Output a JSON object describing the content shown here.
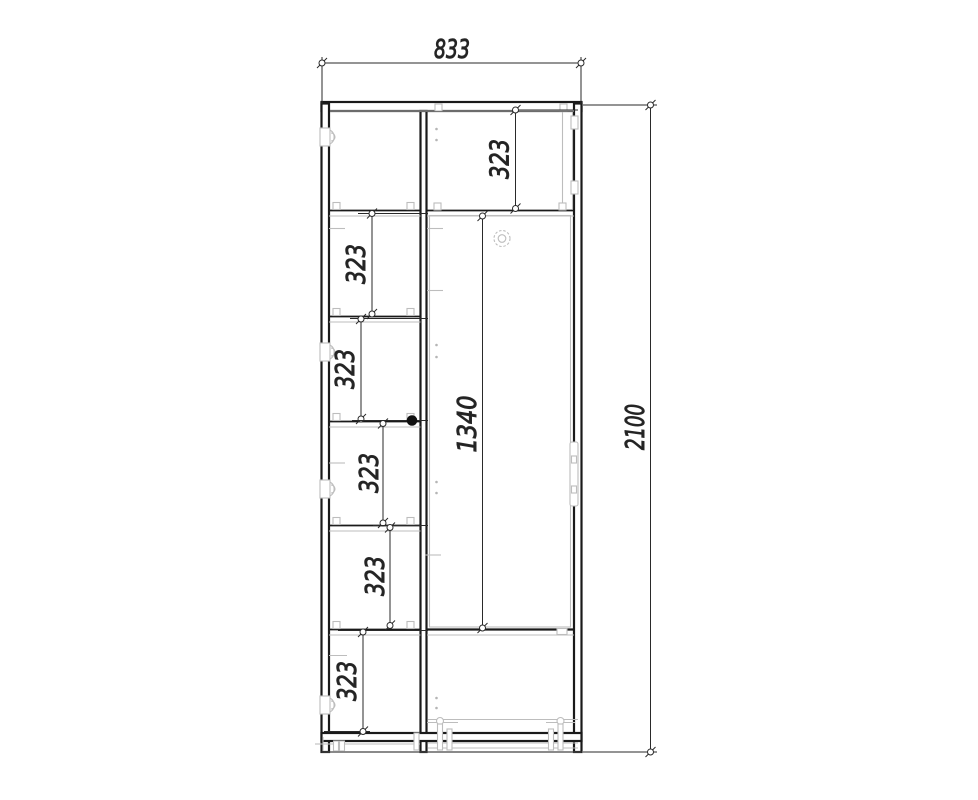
{
  "dimensions": {
    "overall_width": "833",
    "overall_height": "2100",
    "door_height": "1340",
    "top_shelf_height": "323",
    "shelf_spacings": [
      "323",
      "323",
      "323",
      "323",
      "323"
    ]
  },
  "colors": {
    "line": "#1a1a1a",
    "hidden_line": "#bdbdbd",
    "dimension_line": "#2a2a2a",
    "background": "#ffffff"
  }
}
